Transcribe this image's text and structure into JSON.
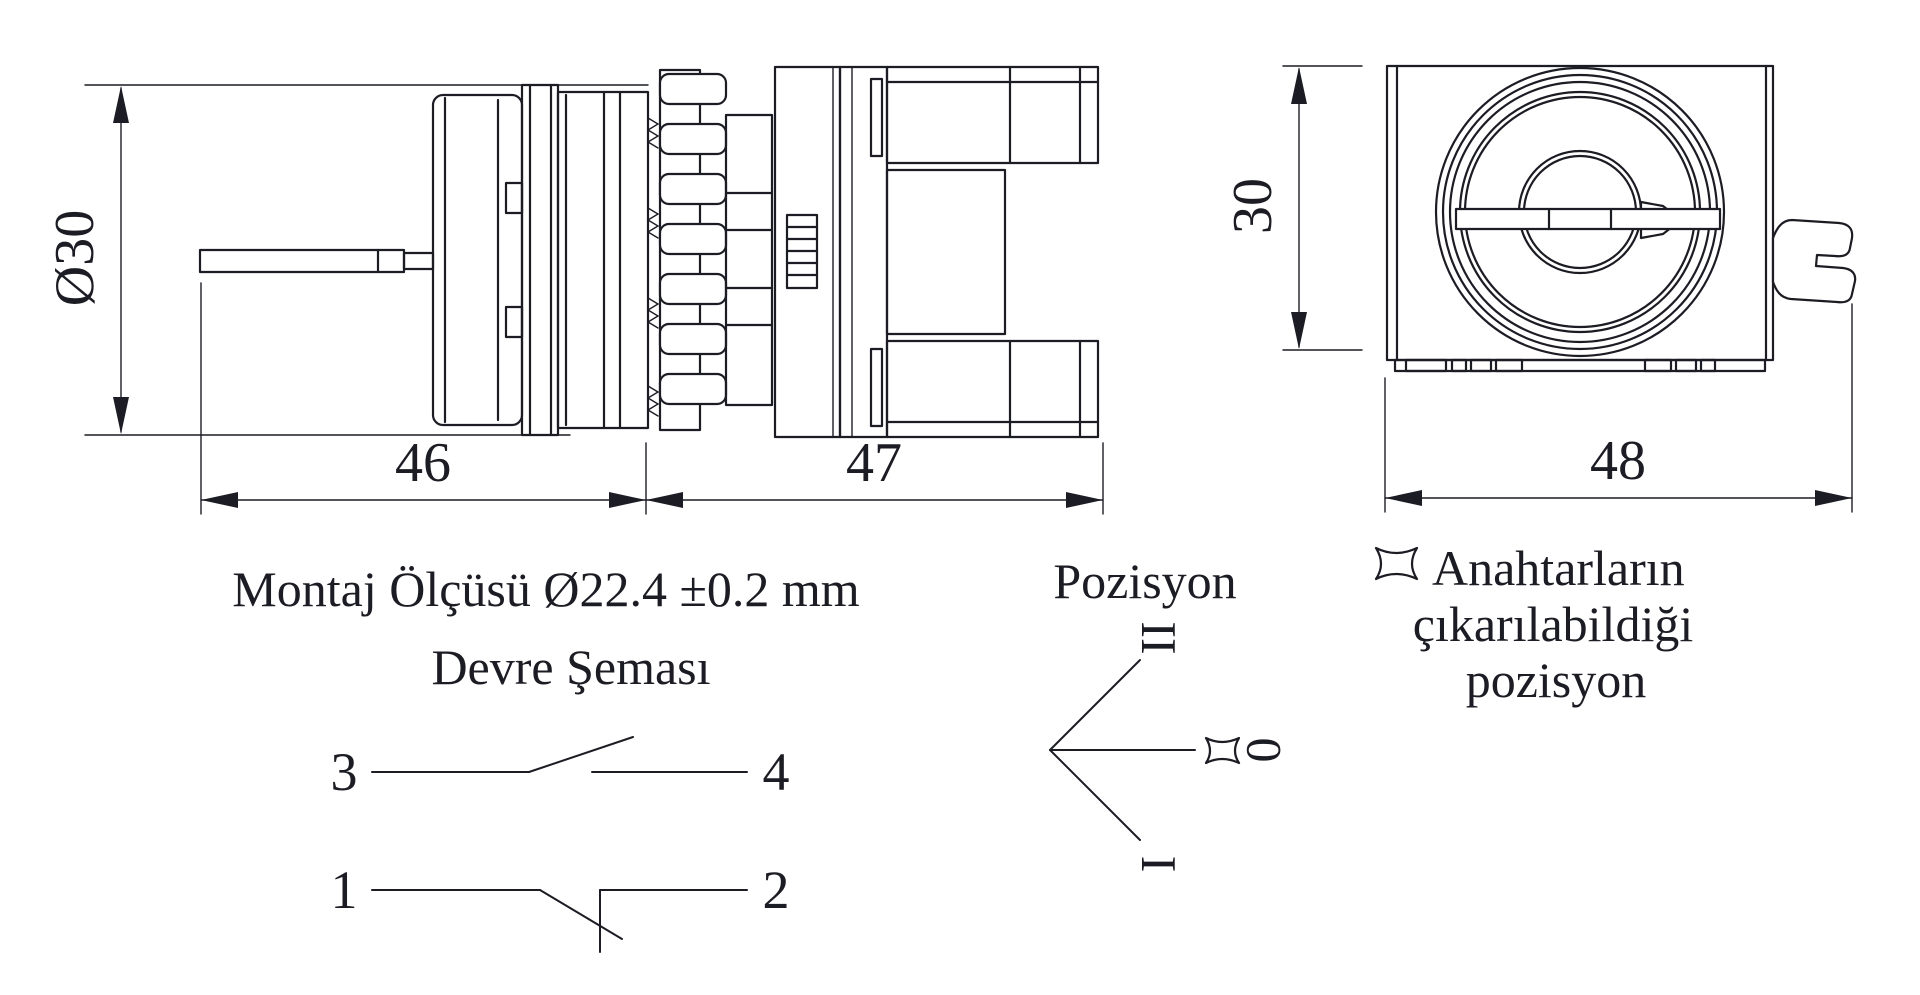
{
  "drawing": {
    "side_view": {
      "diameter_label": "Ø30",
      "front_length_label": "46",
      "block_length_label": "47"
    },
    "front_view": {
      "height_label": "30",
      "width_label": "48"
    },
    "mounting_note": "Montaj Ölçüsü Ø22.4 ±0.2 mm",
    "circuit": {
      "title": "Devre Şeması",
      "no_contact": {
        "left_terminal": "3",
        "right_terminal": "4"
      },
      "nc_contact": {
        "left_terminal": "1",
        "right_terminal": "2"
      }
    },
    "position": {
      "title": "Pozisyon",
      "top_label": "II",
      "middle_label": "0",
      "bottom_label": "I"
    },
    "key_note": {
      "line1": "Anahtarların",
      "line2": "çıkarılabildiği",
      "line3": "pozisyon"
    },
    "colors": {
      "ink": "#1c1c24",
      "background": "#ffffff"
    }
  }
}
